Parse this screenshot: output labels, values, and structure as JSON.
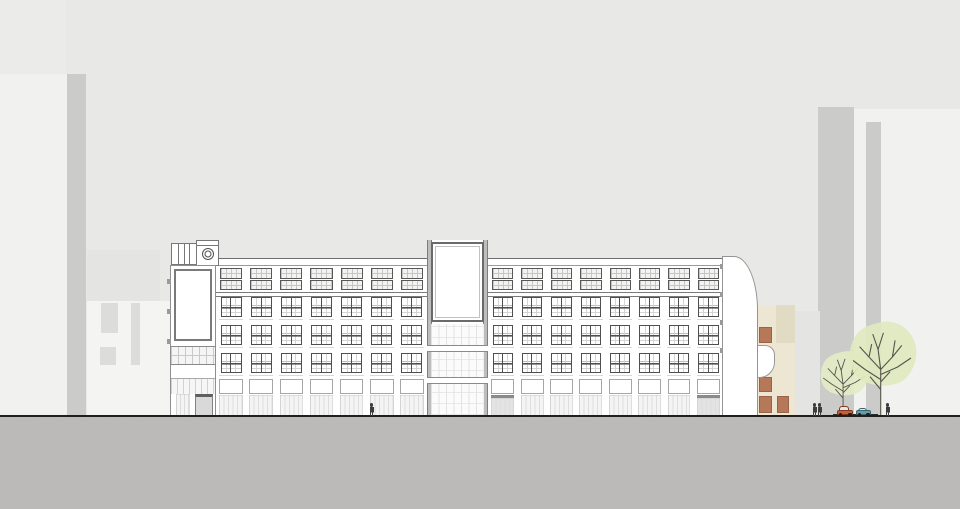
{
  "scene_type": "architectural street elevation drawing of a long multi-storey building with rooftop sign towers, background building silhouettes, two trees, pedestrians and two parked cars",
  "colors": {
    "sky": "#e8e8e7",
    "sky_patch": "#ebebea",
    "ground": "#bdbcba",
    "ground_line": "#1f1f1f",
    "bg_light": "#f1f1f0",
    "bg_lighter": "#f4f4f3",
    "bg_mid": "#e4e4e3",
    "bg_strip": "#cbcbca",
    "bg_window": "#dcdcdb",
    "wall": "#ffffff",
    "glazing": "#f4f4f4",
    "glazing_line": "#dedede",
    "entrance_fill": "#e3e3e3",
    "entrance_bar": "#8a8a8a",
    "door_fill": "#d9d9d9",
    "beige_main": "#ece6d3",
    "beige_dark": "#e2dbc4",
    "beige_window": "#b5795a",
    "beige_window_border": "#9c634a",
    "foliage_small": "#e3ecc6",
    "foliage_large": "#dfe9be",
    "branch": "#55544c",
    "figure": "#3d3d3d",
    "car_window": "#e7e7e2",
    "car_red": "#c4603a",
    "car_red_dark": "#7d3922",
    "car_teal": "#6c9aa3",
    "car_teal_dark": "#3c6670"
  },
  "background_buildings": [
    {
      "name": "bg-sky-patch",
      "x": 0,
      "y": 0,
      "w": 66,
      "h": 76,
      "color": "sky_patch"
    },
    {
      "name": "bg-left-low",
      "x": 0,
      "y": 74,
      "w": 68,
      "h": 342,
      "color": "bg_light"
    },
    {
      "name": "bg-left-strip",
      "x": 67,
      "y": 74,
      "w": 19,
      "h": 342,
      "color": "bg_strip"
    },
    {
      "name": "bg-left-mid-top",
      "x": 87,
      "y": 250,
      "w": 73,
      "h": 52,
      "color": "bg_mid"
    },
    {
      "name": "bg-left-mid",
      "x": 87,
      "y": 301,
      "w": 83,
      "h": 115,
      "color": "bg_lighter"
    },
    {
      "name": "bg-right-tall",
      "x": 853,
      "y": 109,
      "w": 107,
      "h": 307,
      "color": "bg_light"
    },
    {
      "name": "bg-right-strip-a",
      "x": 818,
      "y": 107,
      "w": 36,
      "h": 309,
      "color": "bg_strip"
    },
    {
      "name": "bg-right-strip-b",
      "x": 866,
      "y": 122,
      "w": 15,
      "h": 294,
      "color": "bg_strip"
    },
    {
      "name": "bg-behind-beige",
      "x": 788,
      "y": 311,
      "w": 32,
      "h": 105,
      "color": "bg_mid"
    }
  ],
  "bg_left_windows": [
    {
      "x": 101,
      "y": 303,
      "w": 17,
      "h": 30
    },
    {
      "x": 131,
      "y": 303,
      "w": 9,
      "h": 62
    },
    {
      "x": 100,
      "y": 347,
      "w": 16,
      "h": 18
    }
  ],
  "beige_windows": [
    {
      "x": 2,
      "y": 22,
      "w": 13,
      "h": 16
    },
    {
      "x": 2,
      "y": 72,
      "w": 13,
      "h": 15
    },
    {
      "x": 2,
      "y": 91,
      "w": 13,
      "h": 17
    },
    {
      "x": 20,
      "y": 91,
      "w": 12,
      "h": 17
    }
  ],
  "facade": {
    "top": 258,
    "bottom": 416,
    "attic_upper_y": 267,
    "attic_upper_h": 10.5,
    "attic_lower_y": 279,
    "attic_lower_h": 10,
    "row_ys": [
      296,
      324,
      352
    ],
    "row_h": 20,
    "sill_ys": [
      317.5,
      345.5,
      373.5
    ],
    "spandrel_y": 378,
    "spandrel_h": 15,
    "glazing_y": 394,
    "glazing_h": 20.5,
    "sections": [
      {
        "name": "left",
        "x0": 216,
        "x1": 427,
        "bays": 7,
        "entrance_bays": []
      },
      {
        "name": "right",
        "x0": 488,
        "x1": 723,
        "bays": 8,
        "entrance_bays": [
          0,
          7
        ]
      }
    ]
  },
  "left_tower_ticks": [
    279,
    309,
    339
  ],
  "right_tower_ticks": [
    264,
    292,
    320,
    348
  ],
  "trees": [
    {
      "name": "tree-small",
      "x": 816,
      "y": 348,
      "w": 56,
      "h": 69,
      "foliage": "foliage_small",
      "stroke": 0.9
    },
    {
      "name": "tree-large",
      "x": 843,
      "y": 317,
      "w": 78,
      "h": 100,
      "foliage": "foliage_large",
      "stroke": 1.1
    }
  ],
  "people": [
    {
      "x": 369
    },
    {
      "x": 812
    },
    {
      "x": 817
    },
    {
      "x": 885
    }
  ],
  "cars": [
    {
      "name": "car-red",
      "x": 837,
      "w": 16,
      "h": 10,
      "body": "car_red",
      "dark": "car_red_dark"
    },
    {
      "name": "car-teal",
      "x": 856,
      "w": 15,
      "h": 8,
      "body": "car_teal",
      "dark": "car_teal_dark"
    }
  ]
}
